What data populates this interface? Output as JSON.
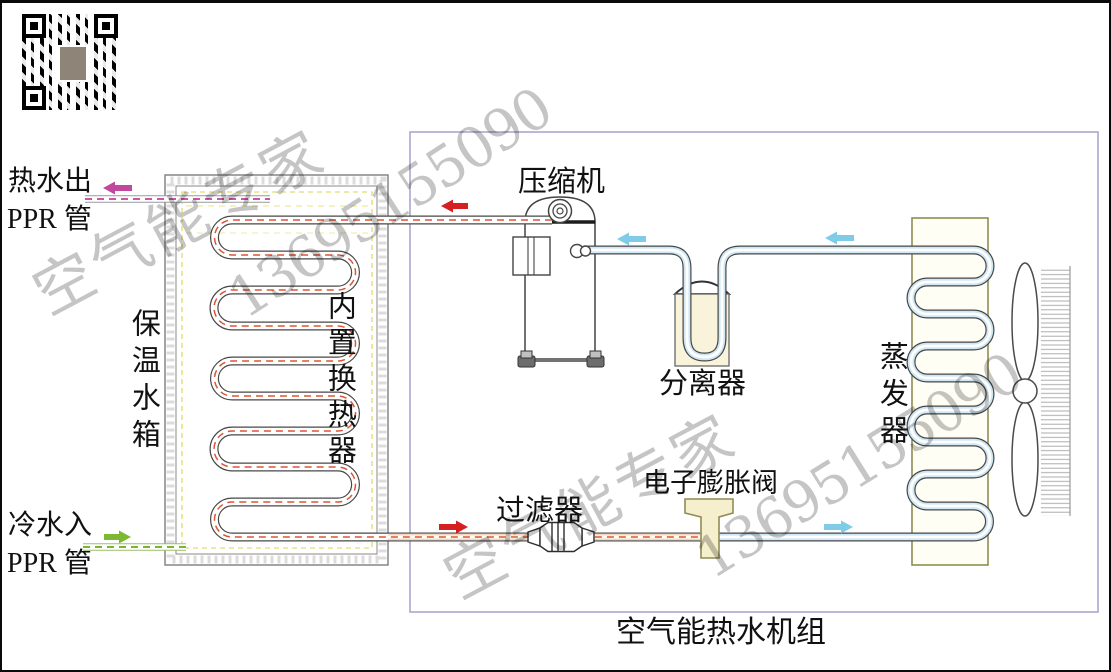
{
  "unit_caption": "空气能热水机组",
  "watermark": {
    "brand": "空气能专家",
    "phone": "13695155090"
  },
  "labels": {
    "hot_water_out": "热水出",
    "hot_water_pipe_type": "PPR 管",
    "cold_water_in": "冷水入",
    "cold_water_pipe_type": "PPR 管",
    "tank": "保温水箱",
    "inner_coil": "内置换热器",
    "compressor": "压缩机",
    "separator": "分离器",
    "evaporator": "蒸发器",
    "filter": "过滤器",
    "expansion_valve": "电子膨胀阀"
  },
  "flows": {
    "hot_water_arrow_color": "#c2489e",
    "cold_water_arrow_color": "#7cb832",
    "hot_refrigerant_arrow_color": "#d42020",
    "cold_refrigerant_arrow_color": "#7fcbe8"
  },
  "icons": {
    "qr": "wechat-qr-code",
    "qr_center": "contact-photo"
  }
}
